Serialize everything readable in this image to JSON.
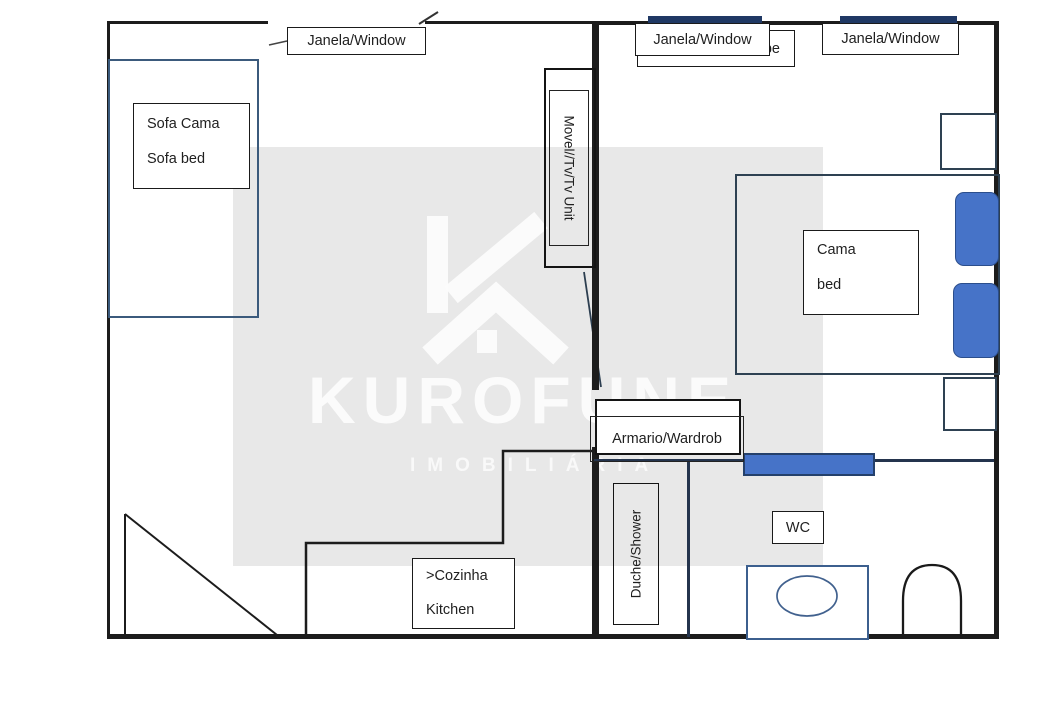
{
  "watermark": {
    "brand": "KUROFUNE",
    "subtitle": "IMOBILIÁRIA",
    "bg_color": "#e8e8e8",
    "text_color": "#fcfcfc"
  },
  "labels": {
    "window_left": "Janela/Window",
    "window_mid": "Janela/Window",
    "window_right": "Janela/Window",
    "hidden_label_fragment": "be",
    "sofa_line1": "Sofa Cama",
    "sofa_line2": "Sofa bed",
    "tv_unit": "Movel//Tv/Tv Unit",
    "bed_line1": "Cama",
    "bed_line2": "bed",
    "wardrobe": "Armario/Wardrob",
    "shower": "Duche/Shower",
    "wc": "WC",
    "kitchen_line1": ">Cozinha",
    "kitchen_line2": "Kitchen"
  },
  "colors": {
    "wall": "#1c1c1c",
    "navy_divider": "#24344d",
    "window_marker": "#1f3864",
    "furniture_blue": "#4673c8",
    "sofa_border": "#3b5a7c",
    "toilet_border": "#3c5f8e"
  }
}
